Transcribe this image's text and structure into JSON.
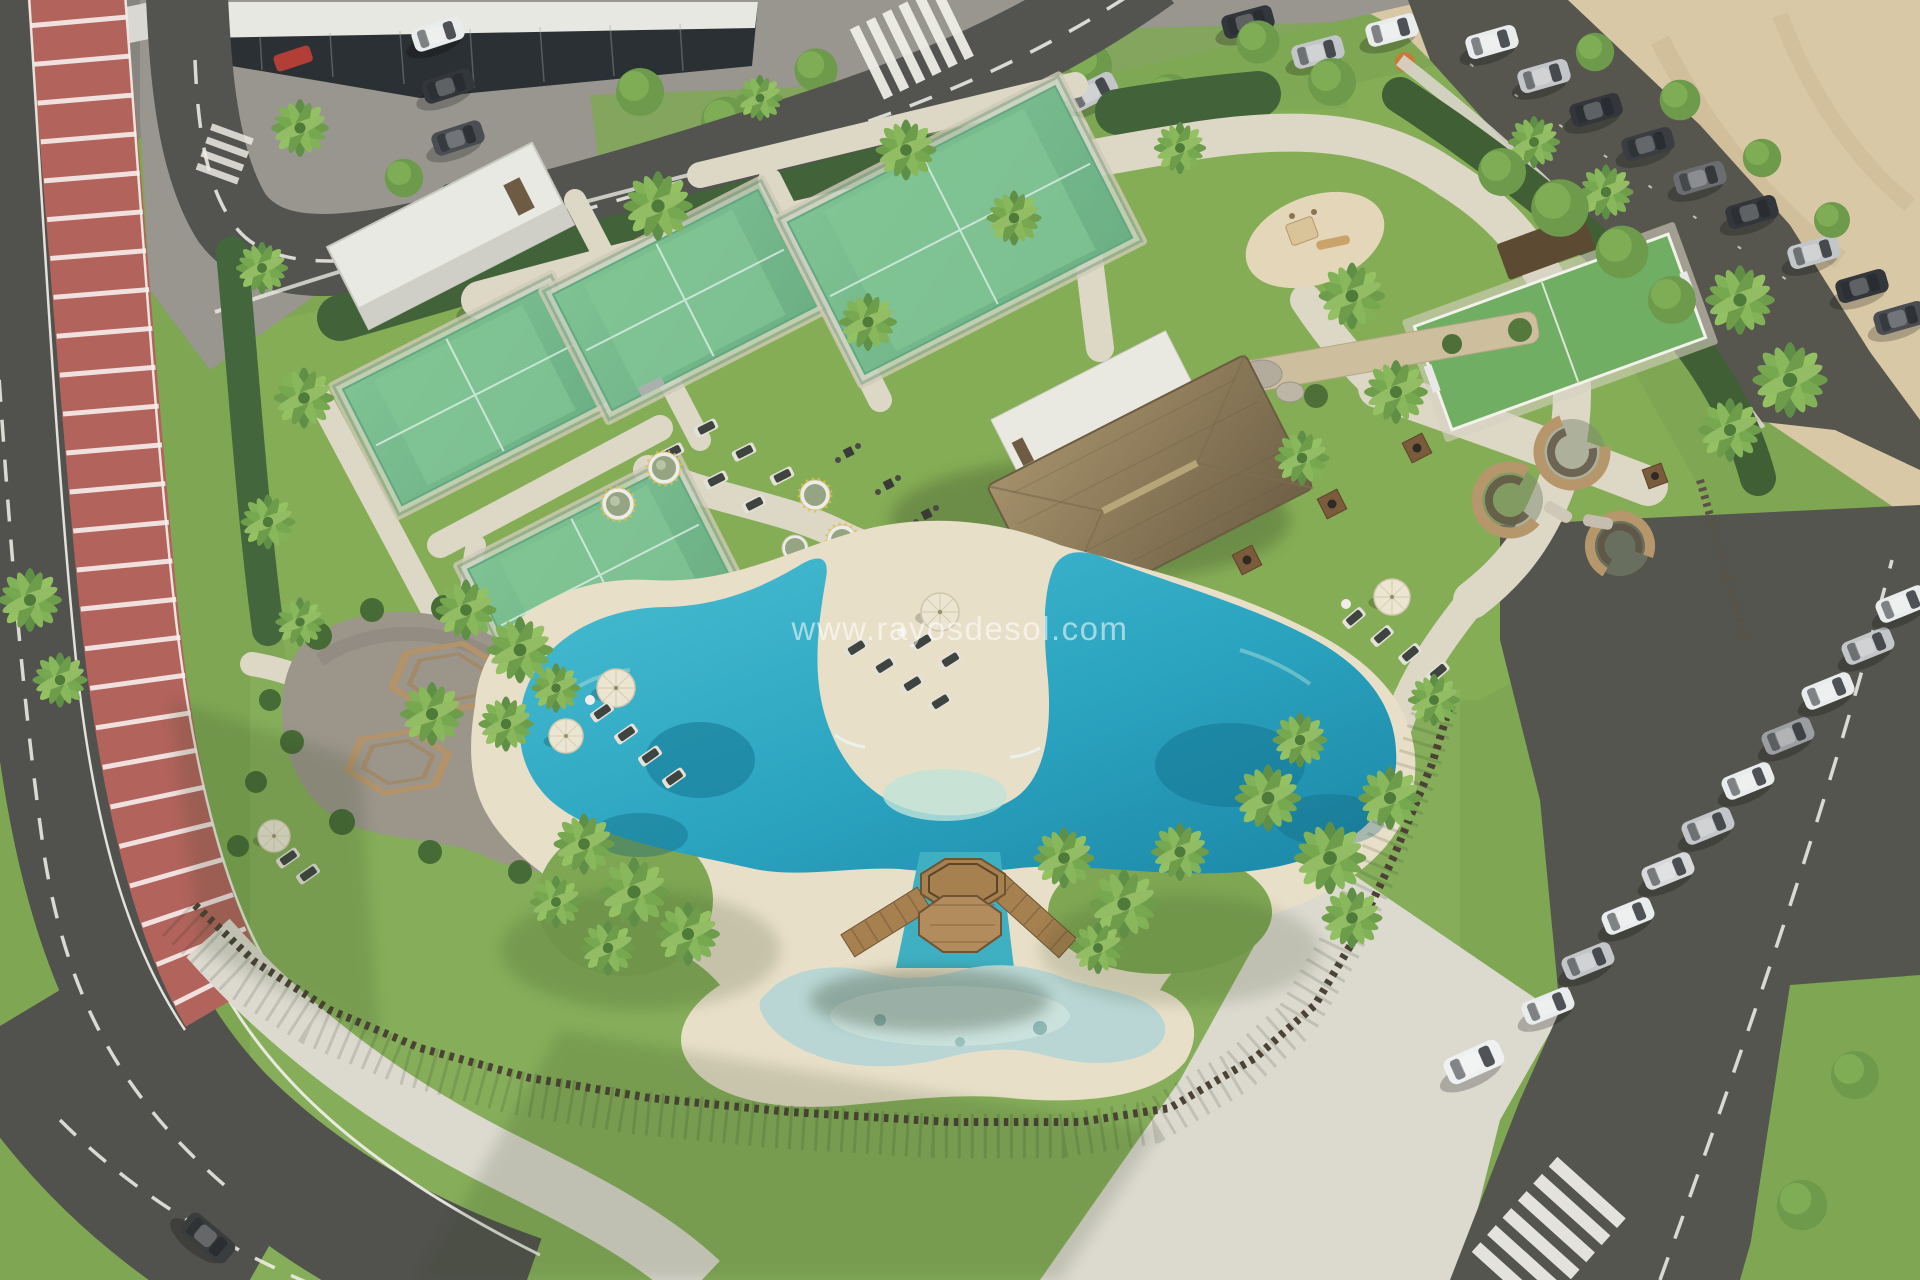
{
  "watermark": {
    "text": "www.rayosdesol.com",
    "color": "#ffffff",
    "opacity": 0.55
  },
  "palette": {
    "lawn": "#7ea653",
    "lawn_light": "#93bd64",
    "lawn_shadow": "#4c6b36",
    "hedge": "#426339",
    "sand_beach": "#e8dfc8",
    "sand_dune": "#d9c8a6",
    "asphalt": "#51514d",
    "sidewalk": "#dcd9cf",
    "cycle_lane": "#b2635c",
    "pool_water": "#2fa9c4",
    "pool_deep": "#116f8c",
    "kids_pool": "#b9d6d4",
    "court_turf": "#5aa873",
    "court_frame": "#2e7d52",
    "thatch_roof": "#8d7d5c",
    "timber": "#a6804f",
    "gravel_plaza": "#9b958a",
    "fence_timber": "#4b4234",
    "car_dark": "#33363a",
    "car_silver": "#c3c6c8",
    "car_white": "#e9ecec",
    "car_red": "#b23f37",
    "parasol": "#ebe5d1",
    "planter": "#eeede5",
    "stone_wall": "#cdbf9e"
  },
  "scene": {
    "setting": "aerial drone view of a resort amenity parcel on a sunny day",
    "lagoon_pool": {
      "label": "lagoon swimming pool with sand beach and central sand peninsula"
    },
    "kids_pool": {
      "label": "children's pool"
    },
    "gazebo": {
      "label": "octagonal timber deck with two foot bridges over a water channel"
    },
    "padel_courts": {
      "label": "glass-walled padel courts",
      "count": 4
    },
    "multisport_court": {
      "label": "mini multisport turf pitch with shelter"
    },
    "playground": {
      "label": "children's playground with slide"
    },
    "swing_frames": {
      "label": "timber swing frames on gravel pads",
      "count": 2
    },
    "bench_plaza": {
      "label": "gravel plaza with hexagonal tree benches",
      "hex_benches": 2
    },
    "lounge_pods": {
      "label": "curved rattan lounge pods",
      "count": 3
    },
    "clubhouse": {
      "label": "pool house with white volume and thatched hip roof"
    },
    "service_building": {
      "label": "white storage building by the courts"
    },
    "office_building": {
      "label": "dark glazed building at top-left"
    },
    "cycle_lane": {
      "label": "red cycle lane with white cross stripes along west street"
    },
    "streets": {
      "label": "perimeter streets with dashed lane markings",
      "crosswalks": 3
    },
    "parking": {
      "west_cars": 6,
      "north_edge_cars": 3,
      "northeast_cars": 9,
      "east_cars": 11,
      "red_vehicles": 3,
      "moving_cars": 2
    },
    "beach_dunes": {
      "label": "sand area beyond north-east car park"
    },
    "vegetation": {
      "palm_trees": 39,
      "round_trees": 20,
      "hedges": "trimmed hedge along north boundary",
      "timber_fence": "slatted timber fence around pool lawn"
    },
    "pool_furniture": {
      "sun_loungers": 16,
      "lawn_loungers": 6,
      "parasols": 6,
      "bbq_stations": 5,
      "white_planters": 5
    }
  }
}
